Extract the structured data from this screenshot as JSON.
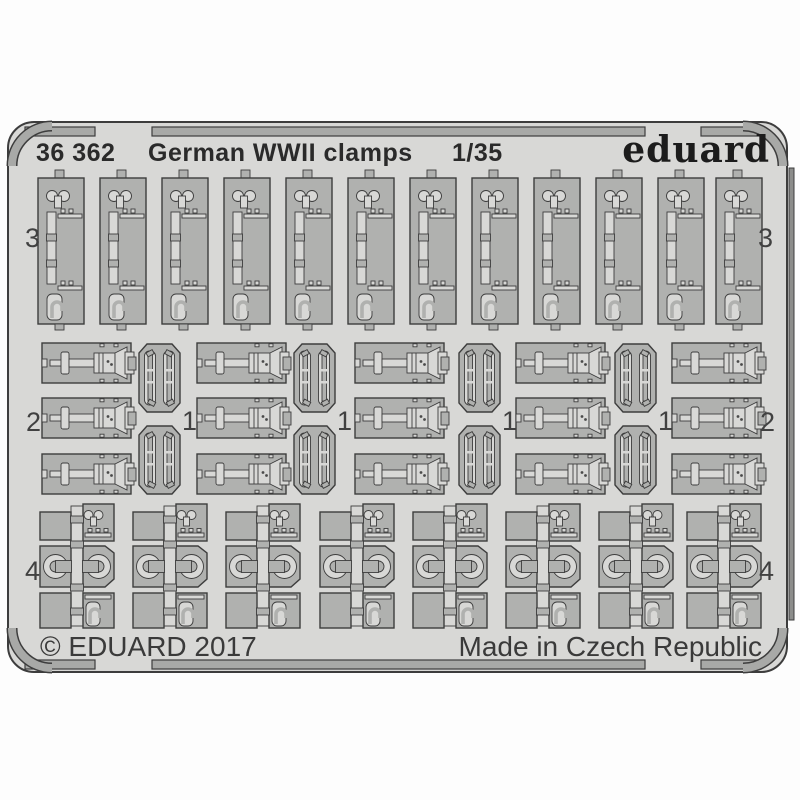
{
  "palette": {
    "background": "#ffffff",
    "sheet": "#d8d8d6",
    "parts": "#b0b1af",
    "frame_rails": "#a8a9a7",
    "outlines": "#3d3d3d"
  },
  "header": {
    "catalog_number": "36 362",
    "product_name": "German WWII clamps",
    "scale": "1/35",
    "brand": "eduard"
  },
  "footer": {
    "copyright": "© EDUARD 2017",
    "origin": "Made in Czech Republic"
  },
  "part_numbers": {
    "top_row": "3",
    "middle_outer": "2",
    "middle_inner": "1",
    "bottom_row": "4"
  },
  "parts_summary": [
    {
      "part_number": "3",
      "count": 12
    },
    {
      "part_number": "2",
      "count": 15
    },
    {
      "part_number": "1",
      "count": 16
    },
    {
      "part_number": "4",
      "count": 8
    }
  ]
}
